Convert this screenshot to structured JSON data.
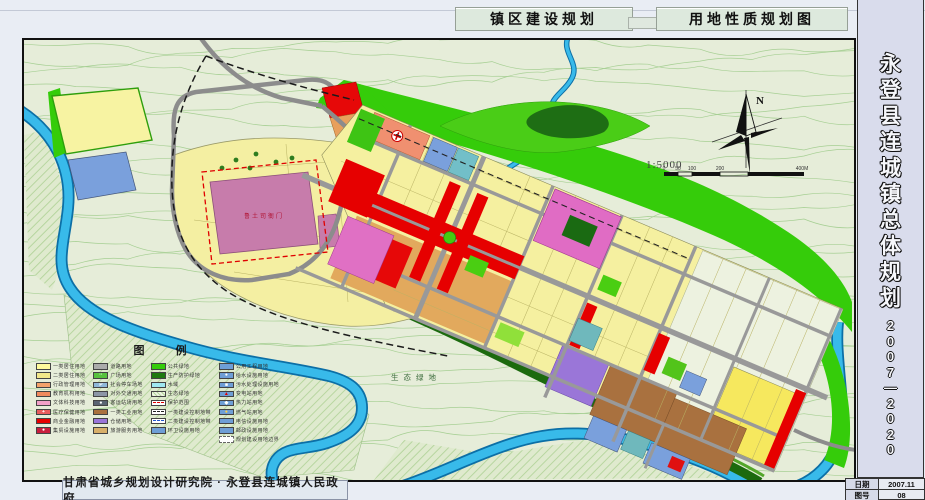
{
  "header": {
    "title_left": "镇区建设规划",
    "title_right": "用地性质规划图"
  },
  "sidebar": {
    "title": "永登县连城镇总体规划",
    "period": "2007—2020",
    "info": [
      {
        "label": "日期",
        "value": "2007.11"
      },
      {
        "label": "图号",
        "value": "08"
      }
    ]
  },
  "footer": {
    "credit": "甘肃省城乡规划设计研究院 · 永登县连城镇人民政府"
  },
  "map": {
    "north_label": "N",
    "scale_text": "1:5000",
    "scale_ticks": [
      "0",
      "50",
      "100",
      "200",
      "400M"
    ],
    "labels": {
      "heritage": "鲁土司衙门",
      "eco": "生态绿地"
    },
    "colors": {
      "water": "#38BAEA",
      "road_gray": "#999999",
      "public_green": "#35CC0A",
      "protect_green": "#1E7A10",
      "residential_yellow": "#F5F0A0",
      "commercial_red": "#E60000",
      "heritage_mauve": "#C77CAB",
      "industry_brown": "#A9713F",
      "warehouse_purple": "#9A76D8",
      "utility_blue": "#6E9ED6"
    },
    "legend": {
      "title": "图  例",
      "columns": [
        [
          {
            "label": "一类居住用地",
            "color": "#FFFA9C",
            "type": "fill"
          },
          {
            "label": "二类居住用地",
            "color": "#F2E88A",
            "type": "fill"
          },
          {
            "label": "行政管理用地",
            "color": "#F4A26B",
            "type": "fill"
          },
          {
            "label": "教育机构用地",
            "color": "#F08A5E",
            "type": "fill"
          },
          {
            "label": "文体科技用地",
            "color": "#F2A0C8",
            "type": "fill"
          },
          {
            "label": "医疗保健用地",
            "color": "#E85C5C",
            "type": "fill",
            "glyph": "+",
            "glyphColor": "#ffffff"
          },
          {
            "label": "商业金融用地",
            "color": "#E60000",
            "type": "fill"
          },
          {
            "label": "集贸设施用地",
            "color": "#C81E3C",
            "type": "fill",
            "glyph": "●",
            "glyphColor": "#ffffff"
          }
        ],
        [
          {
            "label": "道路用地",
            "color": "#ABABAB",
            "type": "fill"
          },
          {
            "label": "广场用地",
            "color": "#57C23E",
            "type": "fill",
            "glyph": "··",
            "glyphColor": "#ffffff"
          },
          {
            "label": "社会停车场地",
            "color": "#8FB8D8",
            "type": "fill",
            "glyph": "P",
            "glyphColor": "#ffffff"
          },
          {
            "label": "对外交通用地",
            "color": "#8C96A6",
            "type": "fill"
          },
          {
            "label": "客运站场用地",
            "color": "#5A6472",
            "type": "fill",
            "glyph": "●",
            "glyphColor": "#ffffff"
          },
          {
            "label": "一类工业用地",
            "color": "#A9713F",
            "type": "fill"
          },
          {
            "label": "仓储用地",
            "color": "#9A76D8",
            "type": "fill"
          },
          {
            "label": "旅游服务用地",
            "color": "#D8B06A",
            "type": "fill"
          }
        ],
        [
          {
            "label": "公共绿地",
            "color": "#35CC0A",
            "type": "fill"
          },
          {
            "label": "生产防护绿地",
            "color": "#1E7A10",
            "type": "fill"
          },
          {
            "label": "水域",
            "color": "#9FE8F0",
            "type": "fill"
          },
          {
            "label": "生态绿地",
            "type": "hatch"
          },
          {
            "label": "保护范围",
            "type": "line-red"
          },
          {
            "label": "一类建设控制地带",
            "type": "line-black"
          },
          {
            "label": "二类建设控制地带",
            "type": "line-blue"
          },
          {
            "label": "环卫设施用地",
            "color": "#6E9ED6",
            "type": "fill"
          }
        ],
        [
          {
            "label": "公用工程用地",
            "color": "#6E9ED6",
            "type": "fill"
          },
          {
            "label": "给水设施用地",
            "color": "#6E9ED6",
            "type": "fill",
            "glyph": "●",
            "glyphColor": "#ffffff"
          },
          {
            "label": "污水处理设施用地",
            "color": "#6E9ED6",
            "type": "fill",
            "glyph": "■",
            "glyphColor": "#ffffff"
          },
          {
            "label": "变电站用地",
            "color": "#6E9ED6",
            "type": "fill",
            "glyph": "▲",
            "glyphColor": "#E00000"
          },
          {
            "label": "热力站用地",
            "color": "#6E9ED6",
            "type": "fill",
            "glyph": "◆",
            "glyphColor": "#ffffff"
          },
          {
            "label": "燃气站用地",
            "color": "#6E9ED6",
            "type": "fill",
            "glyph": "●",
            "glyphColor": "#FFD24A"
          },
          {
            "label": "电信设施用地",
            "color": "#6E9ED6",
            "type": "fill"
          },
          {
            "label": "邮政设施用地",
            "color": "#6E9ED6",
            "type": "fill"
          },
          {
            "label": "规划建设用地边界",
            "type": "boundary"
          }
        ]
      ]
    }
  }
}
